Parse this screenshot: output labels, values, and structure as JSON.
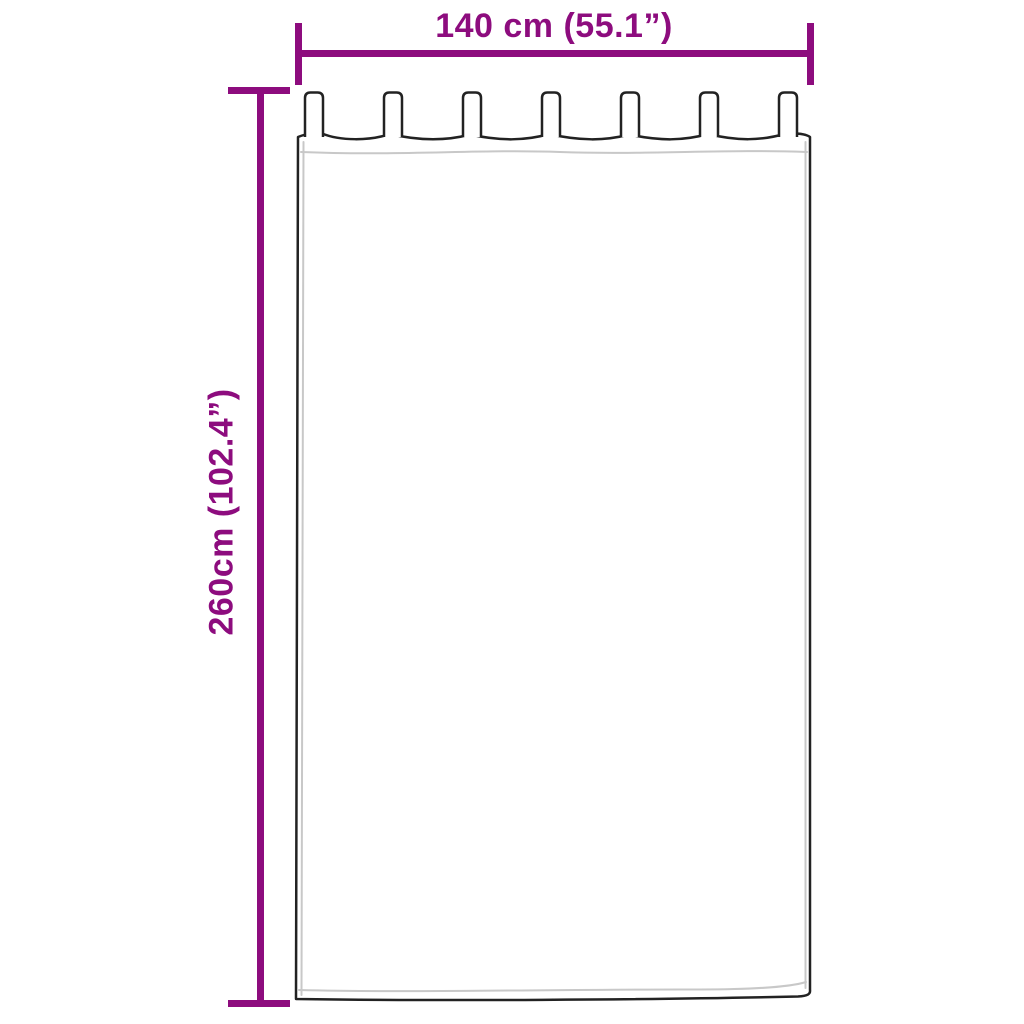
{
  "diagram": {
    "title": "curtain dimension diagram",
    "dimensions": {
      "width_label": "140 cm (55.1”)",
      "height_label": "260cm (102.4”)"
    },
    "curtain": {
      "tab_count": 7
    },
    "colors": {
      "dimension_accent": "#8d0c7e",
      "outline": "#222222",
      "hem_line": "#c8c8c8",
      "background": "#ffffff"
    }
  }
}
